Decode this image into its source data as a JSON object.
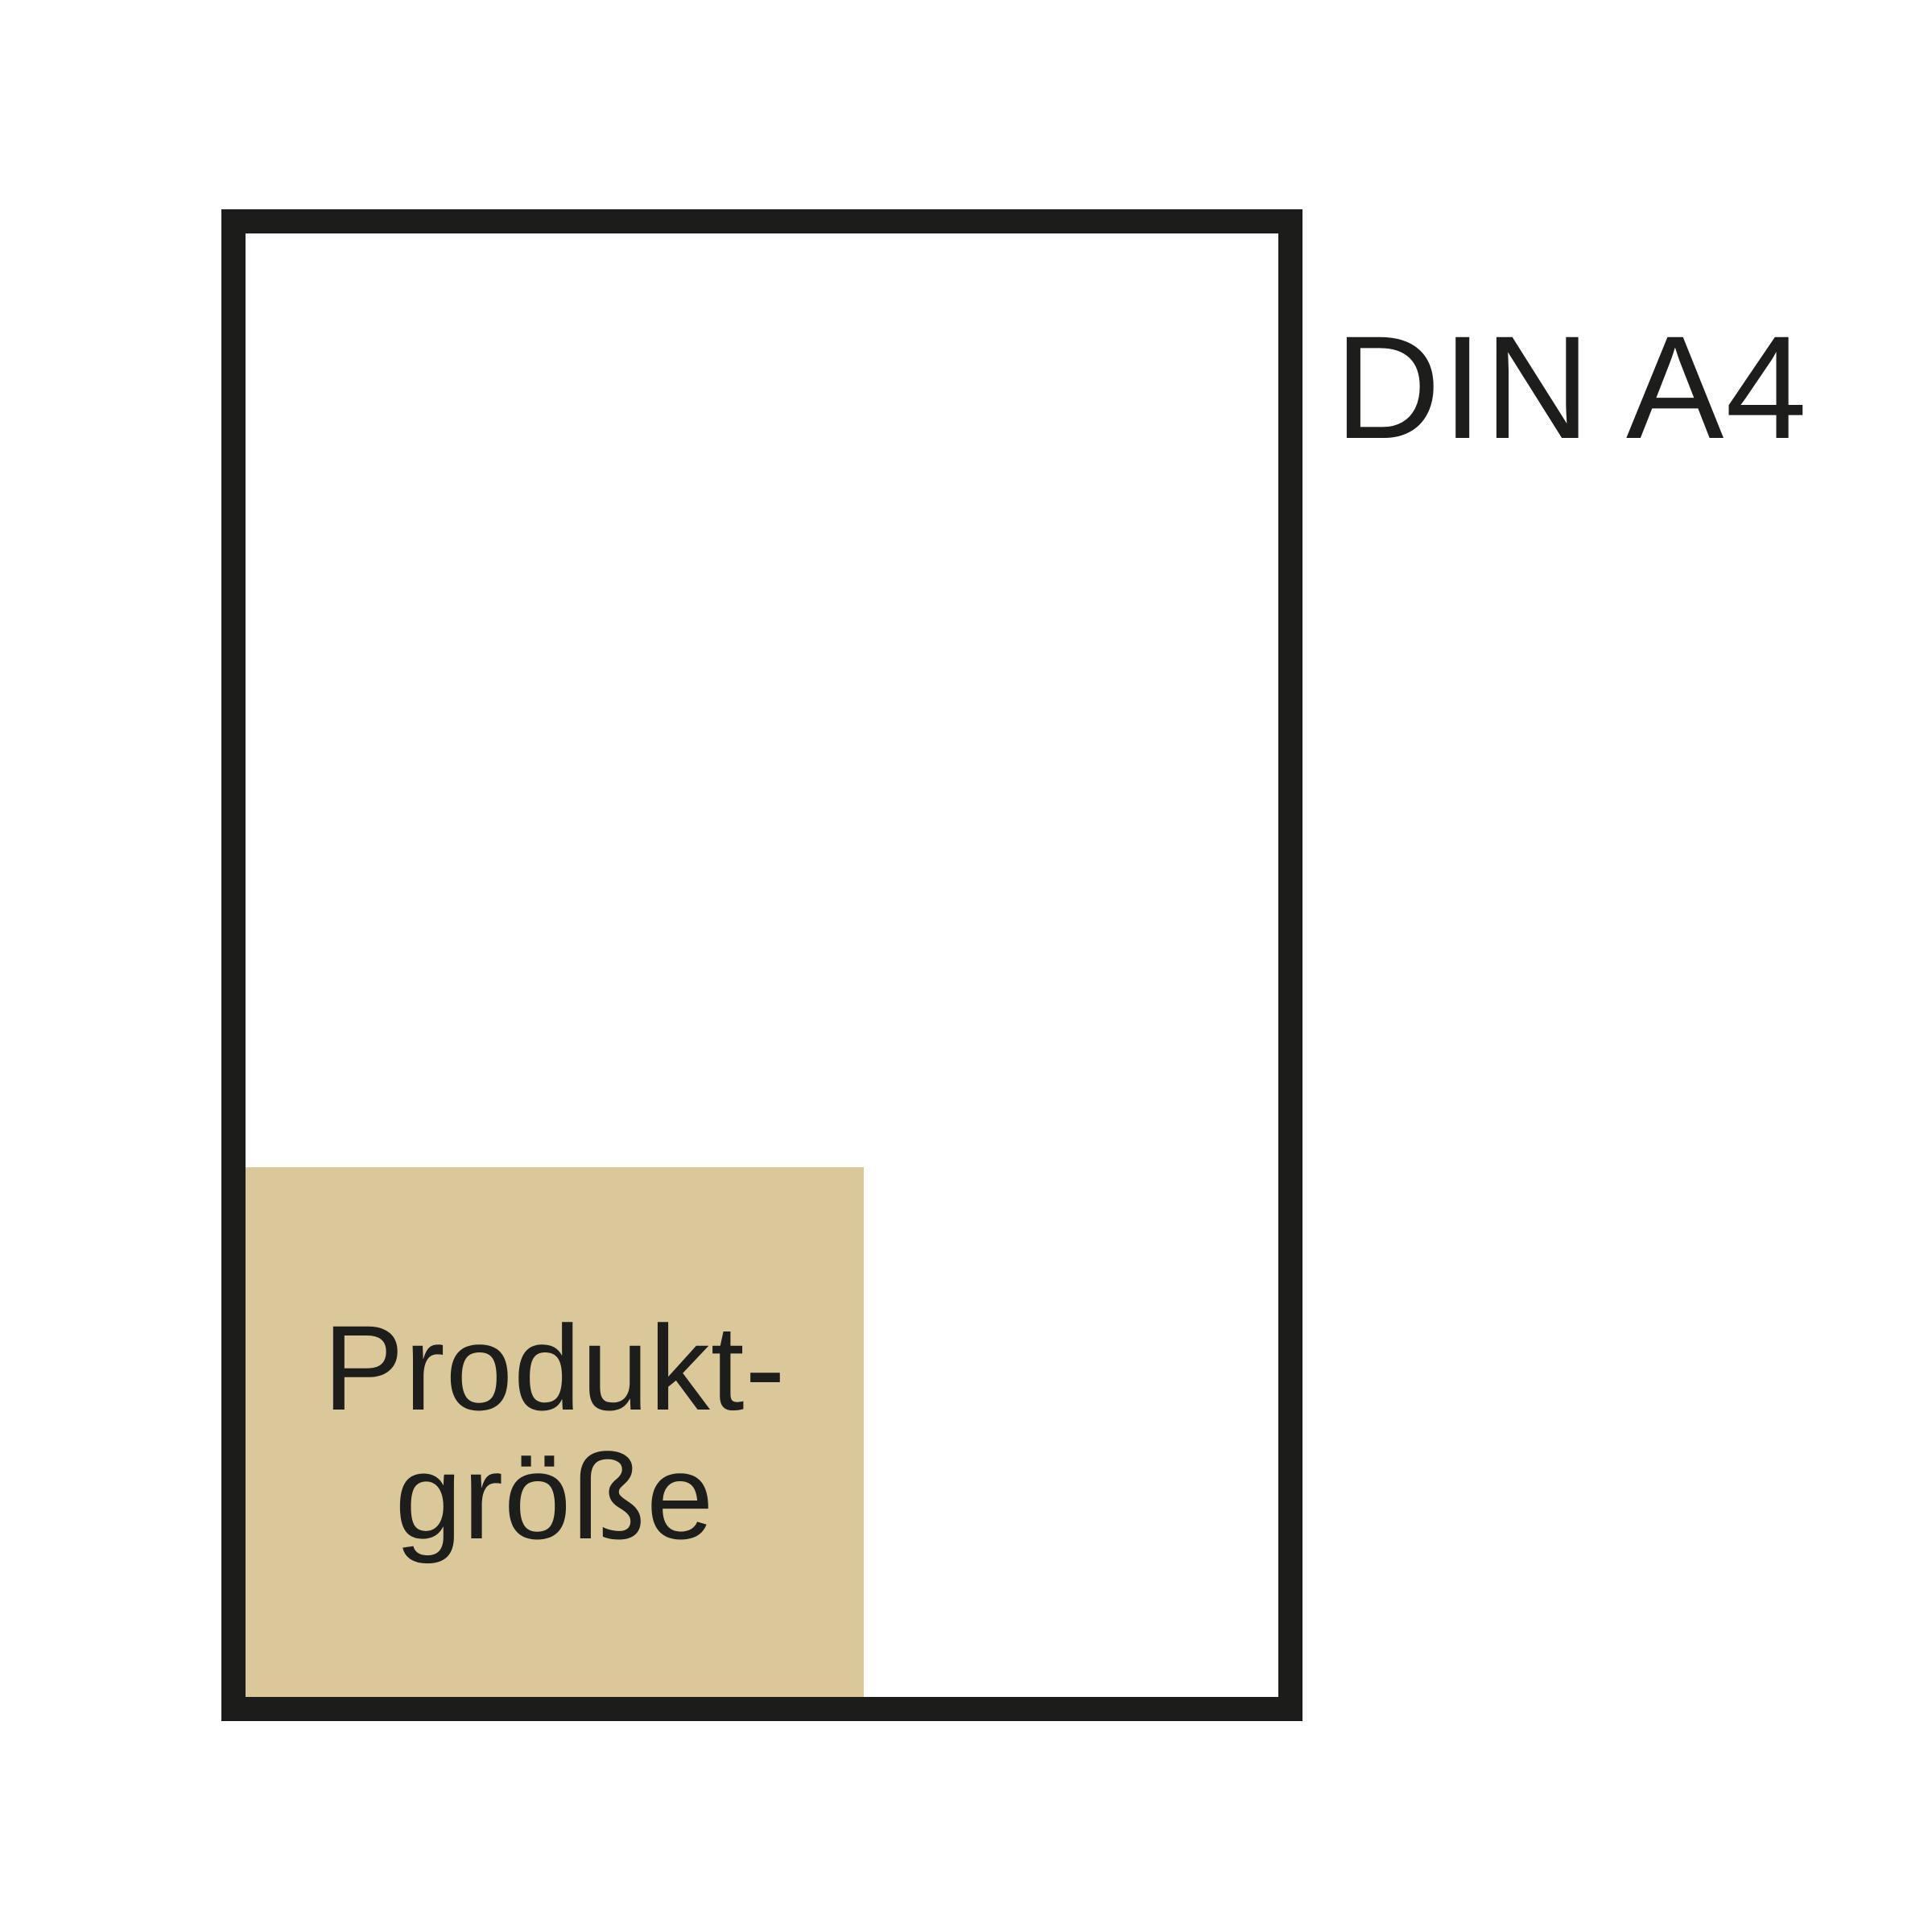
{
  "canvas": {
    "background": "#ffffff"
  },
  "diagram": {
    "type": "size-comparison",
    "frame": {
      "label": "DIN A4",
      "border_color": "#1c1c1a",
      "fill": "#ffffff"
    },
    "product_box": {
      "label_line1": "Produkt-",
      "label_line2": "größe",
      "full_label": "Produktgröße",
      "fill": "#dac89b",
      "text_color": "#1d1d1b",
      "position": "bottom-left-inside-frame"
    }
  }
}
